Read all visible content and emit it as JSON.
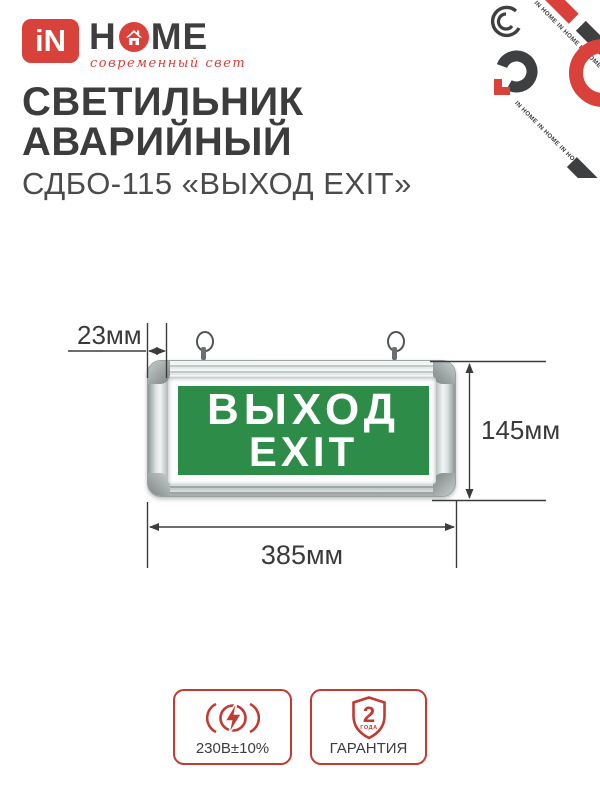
{
  "brand": {
    "logo_square": "iN",
    "word_h": "H",
    "word_me": "ME",
    "tagline": "современный свет",
    "pattern_text_1": "IN HOME  IN HOME  IN HOME",
    "pattern_text_2": "IN HOME  IN HOME  IN HOME"
  },
  "header": {
    "title_line1": "СВЕТИЛЬНИК",
    "title_line2": "АВАРИЙНЫЙ",
    "subtitle": "СДБО-115 «ВЫХОД EXIT»"
  },
  "product": {
    "sign_text_line1": "ВЫХОД",
    "sign_text_line2": "EXIT",
    "dim_depth": "23мм",
    "dim_height": "145мм",
    "dim_width": "385мм"
  },
  "badges": {
    "voltage": {
      "label": "230В±10%",
      "icon": "voltage-lightning-icon"
    },
    "warranty": {
      "label": "ГАРАНТИЯ",
      "icon": "warranty-shield-icon",
      "shield_number": "2",
      "shield_word": "ГОДА"
    }
  },
  "colors": {
    "brand_red": "#d8423a",
    "badge_red": "#c23a31",
    "sign_green": "#2e8c49",
    "title_dark": "#3c3c3c",
    "dim_line": "#3c3c3c",
    "frame_silver": "#c3caca"
  }
}
